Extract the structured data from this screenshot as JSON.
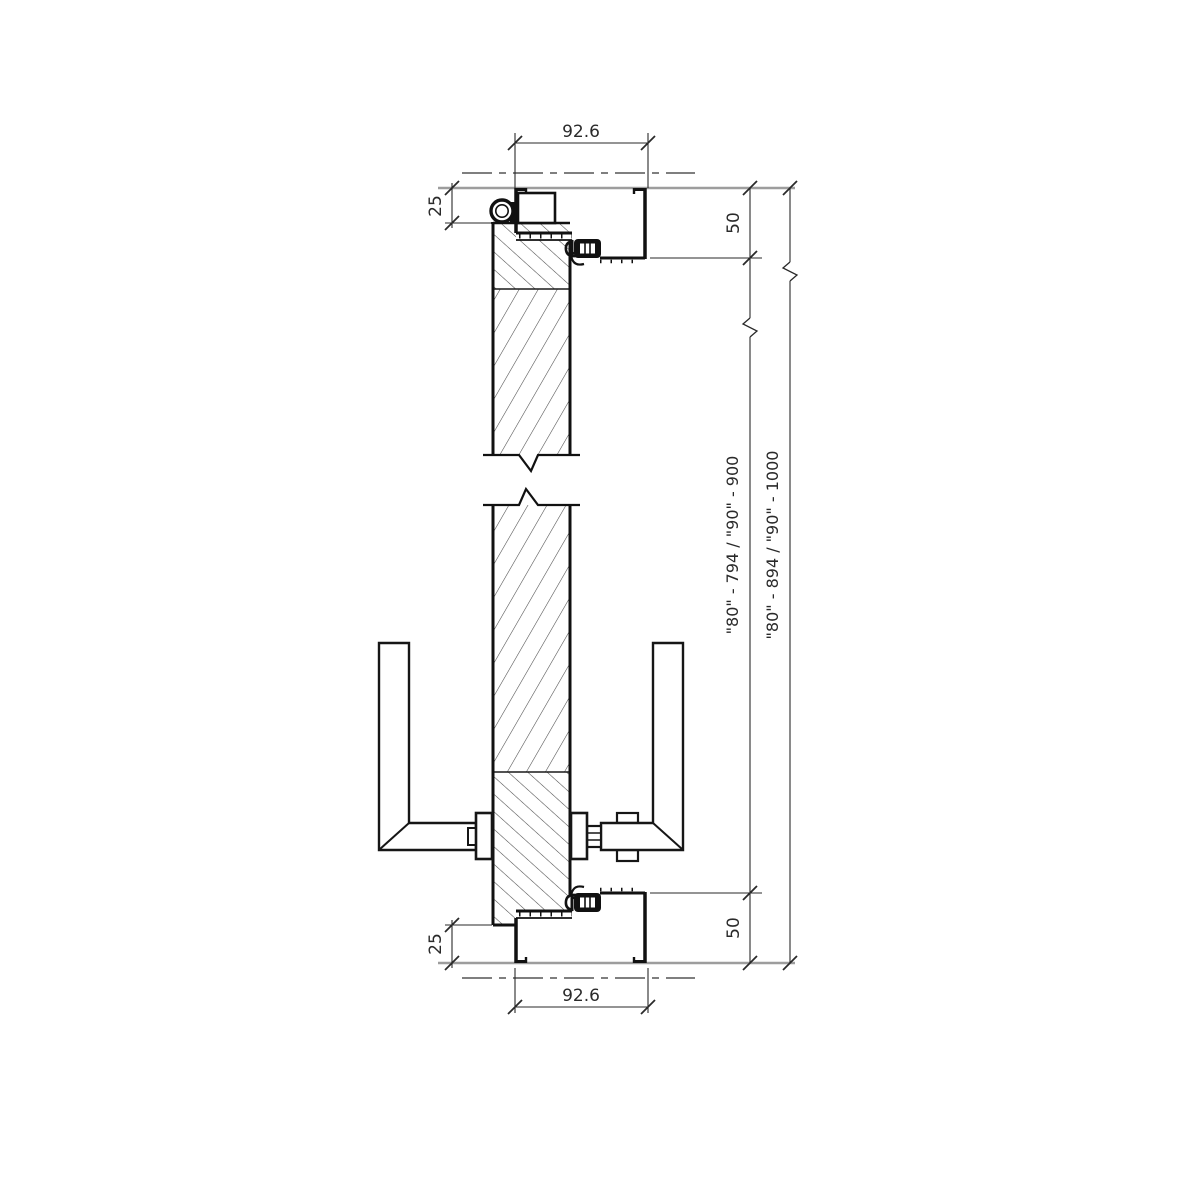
{
  "drawing": {
    "type": "door-frame-vertical-section"
  },
  "dimensions": {
    "frame_width_top": "92.6",
    "frame_width_bottom": "92.6",
    "door_offset_top": "25",
    "door_offset_bottom": "25",
    "frame_height_top": "50",
    "frame_height_bottom": "50",
    "opening_height": "\"80\" - 794 / \"90\" - 900",
    "overall_height": "\"80\" - 894 / \"90\" - 1000"
  },
  "colors": {
    "line": "#1a1a1a",
    "dim_line": "#2a2a2a",
    "wall_line": "#9d9d9d",
    "hatch": "#4a4a4a",
    "background": "#ffffff"
  }
}
